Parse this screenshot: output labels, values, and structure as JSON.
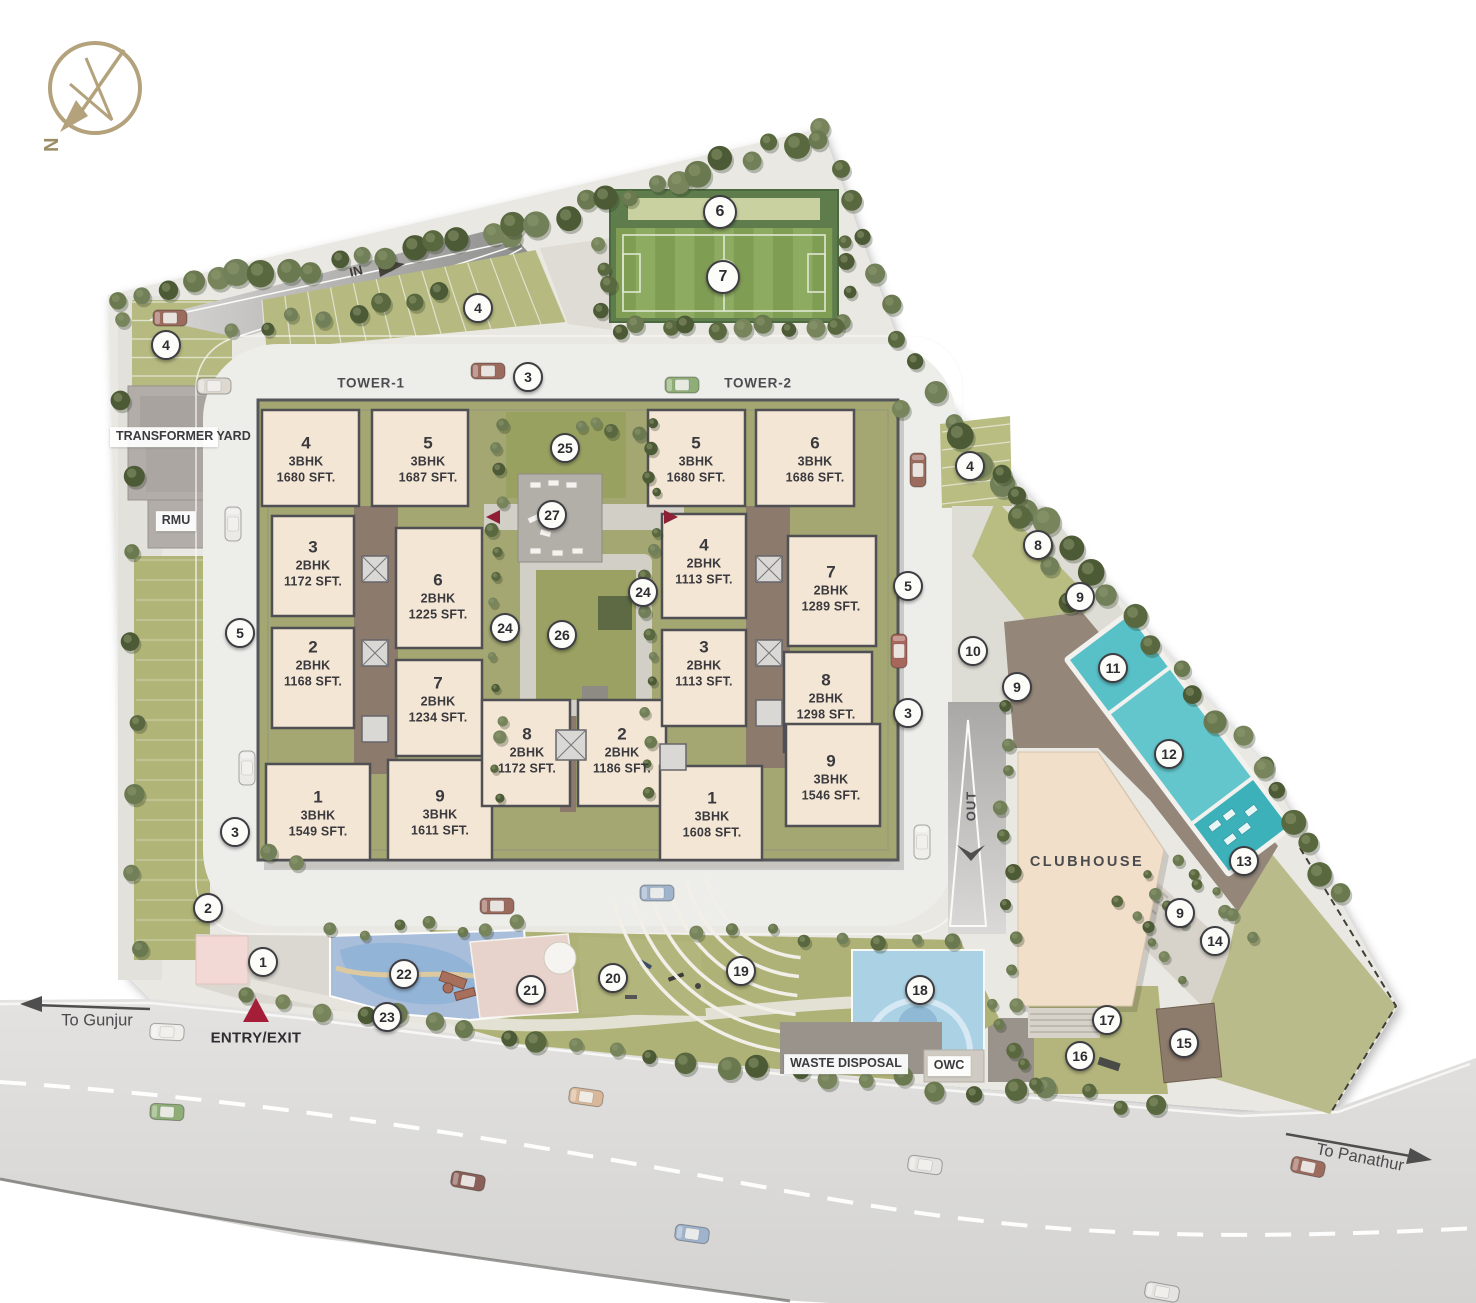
{
  "plan": {
    "compass_label": "N",
    "tower1_label": "TOWER-1",
    "tower2_label": "TOWER-2",
    "transformer_yard": "TRANSFORMER YARD",
    "rmu": "RMU",
    "clubhouse": "CLUBHOUSE",
    "waste_disposal": "WASTE DISPOSAL",
    "owc": "OWC",
    "entry_exit": "ENTRY/EXIT",
    "in_label": "IN",
    "out_label": "OUT",
    "to_gunjur": "To Gunjur",
    "to_panathur": "To Panathur"
  },
  "palette": {
    "unit_fill": "#f4e6d5",
    "block_lawn": "#a4a772",
    "field_green": "#85a159",
    "pool_teal": "#5fc4cb",
    "accent_red": "#a51e38",
    "road_gray": "#dddcd9",
    "clubhouse_fill": "#f1dfca"
  },
  "tower1": {
    "units": [
      {
        "unit": "4",
        "type": "3BHK",
        "area": "1680 SFT."
      },
      {
        "unit": "5",
        "type": "3BHK",
        "area": "1687 SFT."
      },
      {
        "unit": "3",
        "type": "2BHK",
        "area": "1172 SFT."
      },
      {
        "unit": "6",
        "type": "2BHK",
        "area": "1225 SFT."
      },
      {
        "unit": "2",
        "type": "2BHK",
        "area": "1168 SFT."
      },
      {
        "unit": "7",
        "type": "2BHK",
        "area": "1234 SFT."
      },
      {
        "unit": "8",
        "type": "2BHK",
        "area": "1172 SFT."
      },
      {
        "unit": "1",
        "type": "3BHK",
        "area": "1549 SFT."
      },
      {
        "unit": "9",
        "type": "3BHK",
        "area": "1611 SFT."
      }
    ]
  },
  "tower2": {
    "units": [
      {
        "unit": "5",
        "type": "3BHK",
        "area": "1680 SFT."
      },
      {
        "unit": "6",
        "type": "3BHK",
        "area": "1686 SFT."
      },
      {
        "unit": "4",
        "type": "2BHK",
        "area": "1113 SFT."
      },
      {
        "unit": "7",
        "type": "2BHK",
        "area": "1289 SFT."
      },
      {
        "unit": "3",
        "type": "2BHK",
        "area": "1113 SFT."
      },
      {
        "unit": "8",
        "type": "2BHK",
        "area": "1298 SFT."
      },
      {
        "unit": "2",
        "type": "2BHK",
        "area": "1186 SFT."
      },
      {
        "unit": "1",
        "type": "3BHK",
        "area": "1608 SFT."
      },
      {
        "unit": "9",
        "type": "3BHK",
        "area": "1546 SFT."
      }
    ]
  },
  "markers": [
    {
      "label": "1"
    },
    {
      "label": "2"
    },
    {
      "label": "3"
    },
    {
      "label": "3"
    },
    {
      "label": "3"
    },
    {
      "label": "4"
    },
    {
      "label": "4"
    },
    {
      "label": "4"
    },
    {
      "label": "5"
    },
    {
      "label": "5"
    },
    {
      "label": "6"
    },
    {
      "label": "7"
    },
    {
      "label": "8"
    },
    {
      "label": "9"
    },
    {
      "label": "9"
    },
    {
      "label": "9"
    },
    {
      "label": "10"
    },
    {
      "label": "11"
    },
    {
      "label": "12"
    },
    {
      "label": "13"
    },
    {
      "label": "14"
    },
    {
      "label": "15"
    },
    {
      "label": "16"
    },
    {
      "label": "17"
    },
    {
      "label": "18"
    },
    {
      "label": "19"
    },
    {
      "label": "20"
    },
    {
      "label": "21"
    },
    {
      "label": "22"
    },
    {
      "label": "23"
    },
    {
      "label": "24"
    },
    {
      "label": "24"
    },
    {
      "label": "25"
    },
    {
      "label": "26"
    },
    {
      "label": "27"
    }
  ]
}
